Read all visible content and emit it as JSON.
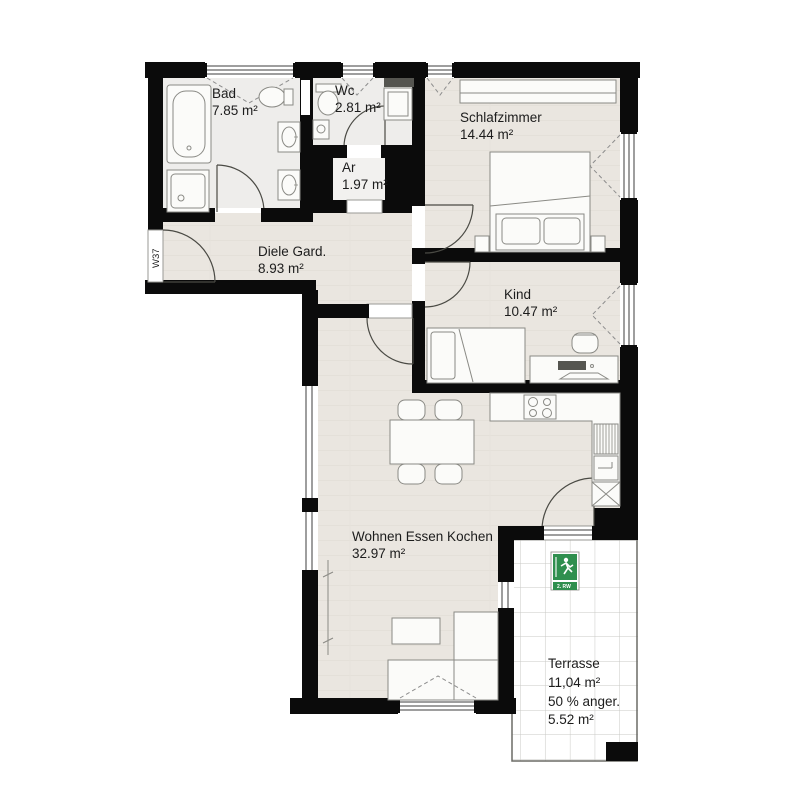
{
  "plan": {
    "unit_label": "W37",
    "rooms": [
      {
        "id": "bad",
        "name": "Bad",
        "area": "7.85 m²"
      },
      {
        "id": "wc",
        "name": "Wc",
        "area": "2.81 m²"
      },
      {
        "id": "ar",
        "name": "Ar",
        "area": "1.97 m²"
      },
      {
        "id": "schlafzimmer",
        "name": "Schlafzimmer",
        "area": "14.44 m²"
      },
      {
        "id": "diele",
        "name": "Diele Gard.",
        "area": "8.93 m²"
      },
      {
        "id": "kind",
        "name": "Kind",
        "area": "10.47 m²"
      },
      {
        "id": "wohnen",
        "name": "Wohnen Essen Kochen",
        "area": "32.97 m²"
      },
      {
        "id": "terrasse",
        "name": "Terrasse",
        "area": "11,04 m²",
        "note1": "50 % anger.",
        "note2": "5.52 m²"
      }
    ],
    "exit_sign": {
      "label": "2. RW"
    },
    "colors": {
      "wall": "#0b0b0b",
      "floor": "#eae6e0",
      "floor-wet": "#eeedeb",
      "terrace": "#ffffff",
      "grid": "#c9c9c5",
      "furn": "#fbfbf9",
      "furnstroke": "#8a8a85",
      "sign-green": "#2f8f4e",
      "text": "#1c1c1c"
    }
  }
}
